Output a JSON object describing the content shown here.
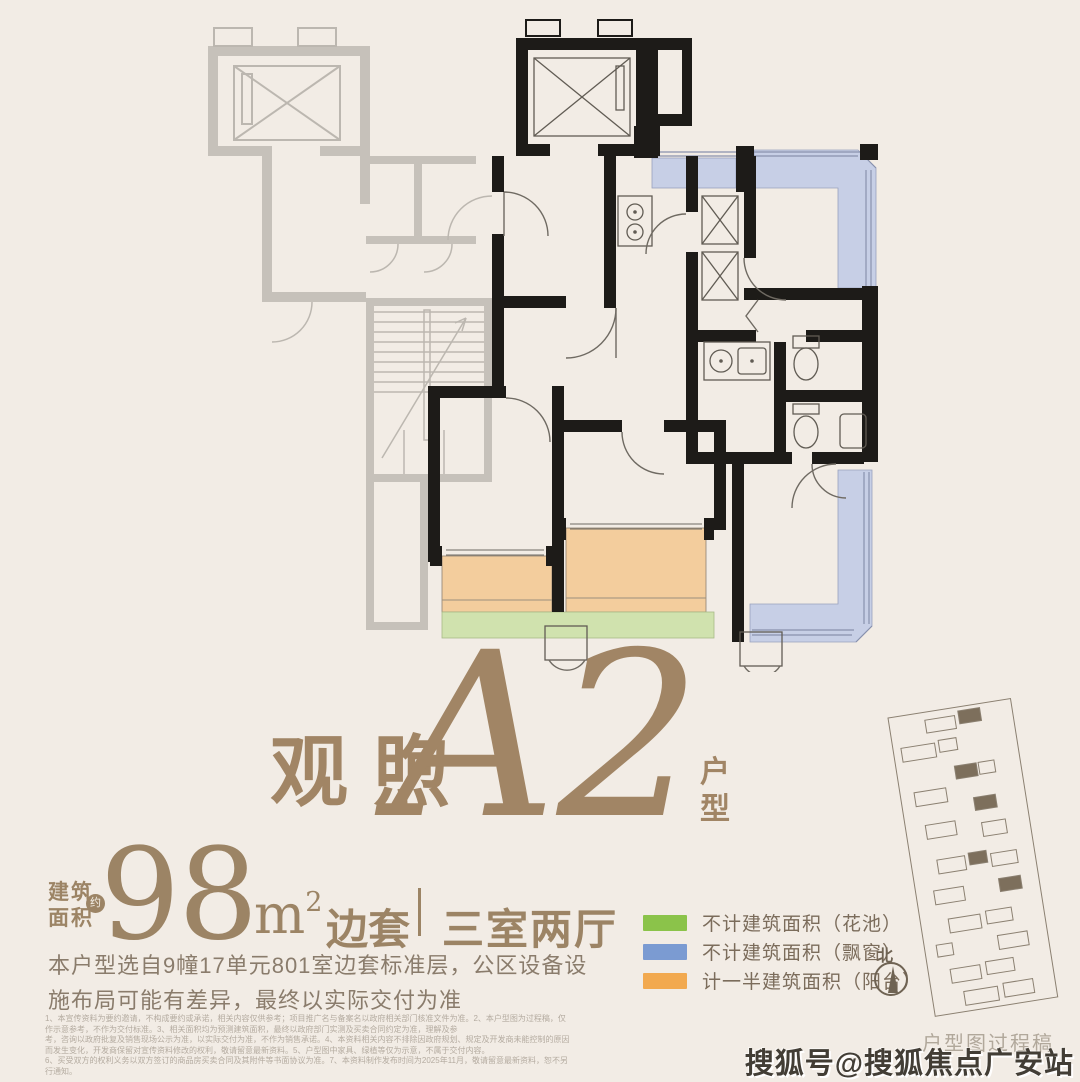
{
  "page": {
    "background": "#f2ece5"
  },
  "title": {
    "name_cn": "观煦",
    "unit_code": "A2",
    "suffix": "户型"
  },
  "area": {
    "label": "建筑面积",
    "approx_badge": "约",
    "value": "98",
    "unit_base": "m",
    "unit_sup": "2",
    "position_tag": "边套",
    "divider": "｜",
    "layout": "三室两厅"
  },
  "description": {
    "line1": "本户型选自9幢17单元801室边套标准层，公区设备设",
    "line2": "施布局可能有差异，最终以实际交付为准"
  },
  "floor_plan": {
    "legend": [
      {
        "label": "不计建筑面积（花池）",
        "color": "#8bc34a"
      },
      {
        "label": "不计建筑面积（飘窗）",
        "color": "#7b9bd2"
      },
      {
        "label": "计一半建筑面积（阳台）",
        "color": "#f2a94f"
      }
    ],
    "north_label": "北"
  },
  "footnotes": {
    "line1": "1、本宣传资料为要约邀请，不构成要约或承诺，相关内容仅供参考；项目推广名与备案名以政府相关部门核准文件为准。2、本户型图为过程稿，仅作示意参考，不作为交付标准。3、相关面积均为预测建筑面积，最终以政府部门实测及买卖合同约定为准，理解及参",
    "line2": "考，咨询以政府批复及销售现场公示为准，以实际交付为准，不作为销售承诺。4、本资料相关内容不排除因政府规划、规定及开发商未能控制的原因而发生变化，开发商保留对宣传资料修改的权利，敬请留意最新资料。5、户型图中家具、绿植等仅为示意，不属于交付内容。",
    "line3": "6、买受双方的权利义务以双方签订的商品房买卖合同及其附件等书面协议为准。7、本资料制作发布时间为2025年11月，敬请留意最新资料，恕不另行通知。"
  },
  "draft_label": "户型图过程稿",
  "watermark": "搜狐号@搜狐焦点广安站"
}
